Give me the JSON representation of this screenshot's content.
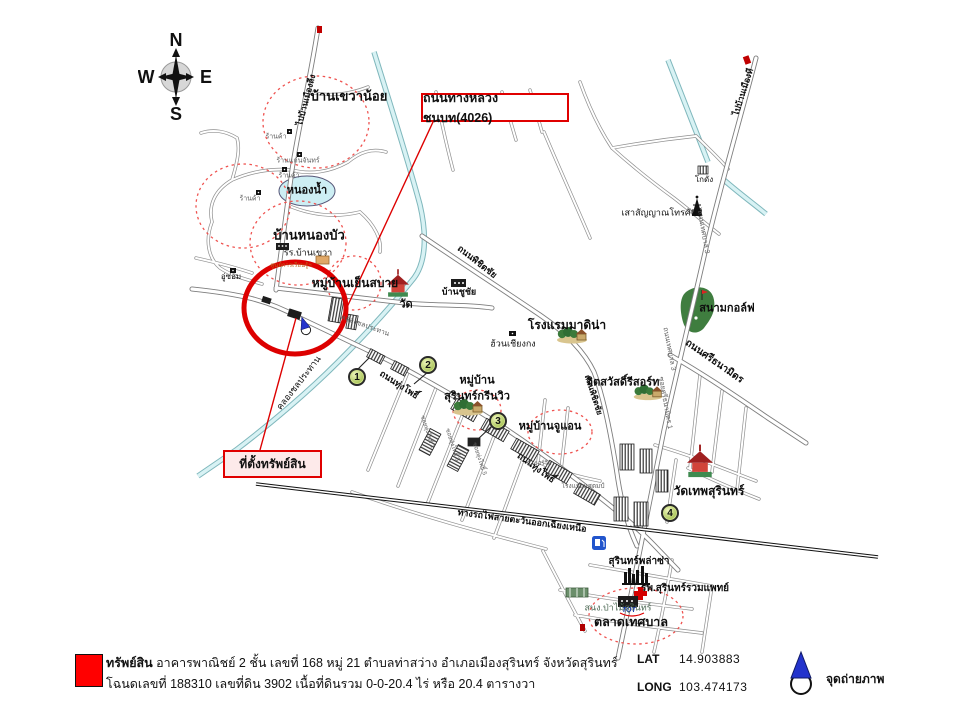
{
  "compass": {
    "n": "N",
    "e": "E",
    "s": "S",
    "w": "W"
  },
  "callouts": {
    "road": "ถนนทางหลวงชนบท(4026)",
    "site": "ที่ตั้งทรัพย์สิน"
  },
  "legend": {
    "swatch_color": "#ff0000",
    "property_bold": "ทรัพย์สิน",
    "property_rest": " อาคารพาณิชย์ 2 ชั้น เลขที่ 168 หมู่ 21  ตำบลท่าสว่าง  อำเภอเมืองสุรินทร์  จังหวัดสุรินทร์",
    "deed_line": "โฉนดเลขที่ 188310 เลขที่ดิน 3902 เนื้อที่ดินรวม 0-0-20.4 ไร่ หรือ 20.4  ตารางวา",
    "lat_label": "LAT",
    "lat_value": "14.903883",
    "long_label": "LONG",
    "long_value": "103.474173",
    "photo_point": "จุดถ่ายภาพ"
  },
  "map": {
    "labels": [
      {
        "t": "ไปบ้านเมืองลีง",
        "x": 306,
        "y": 100,
        "r": -75,
        "s": 8.5,
        "b": 1
      },
      {
        "t": "บ้านเขวาน้อย",
        "x": 349,
        "y": 96,
        "s": 13,
        "b": 1
      },
      {
        "t": "ร้านค้า",
        "x": 276,
        "y": 137,
        "s": 7,
        "c": "gray"
      },
      {
        "t": "ร้านแก่นจันทร์",
        "x": 298,
        "y": 161,
        "s": 7,
        "c": "gray"
      },
      {
        "t": "ร้านค้า",
        "x": 289,
        "y": 176,
        "s": 7,
        "c": "gray"
      },
      {
        "t": "หนองน้ำ",
        "x": 307,
        "y": 191,
        "s": 11,
        "b": 1
      },
      {
        "t": "ร้านค้า",
        "x": 250,
        "y": 199,
        "s": 7,
        "c": "gray"
      },
      {
        "t": "บ้านหนองบัว",
        "x": 309,
        "y": 235,
        "s": 13,
        "b": 1
      },
      {
        "t": "รร.บ้านเขวา",
        "x": 308,
        "y": 253,
        "s": 9
      },
      {
        "t": "ศูนย์การเรียนรู้ฯ",
        "x": 291,
        "y": 266,
        "s": 6,
        "c": "orange"
      },
      {
        "t": "อู่ซ่อม",
        "x": 231,
        "y": 277,
        "s": 8
      },
      {
        "t": "หมู่บ้านเย็นสบาย",
        "x": 355,
        "y": 283,
        "s": 12,
        "b": 1
      },
      {
        "t": "วัด",
        "x": 406,
        "y": 305,
        "s": 11,
        "b": 1
      },
      {
        "t": "บ้านชูชัย",
        "x": 459,
        "y": 292,
        "s": 9,
        "b": 1
      },
      {
        "t": "ถนนพิชิตชัย",
        "x": 477,
        "y": 262,
        "r": 38,
        "s": 9,
        "b": 1
      },
      {
        "t": "โรงแรมมาดิน่า",
        "x": 567,
        "y": 325,
        "s": 12,
        "b": 1
      },
      {
        "t": "ฮ้วนเชียงกง",
        "x": 513,
        "y": 344,
        "s": 9
      },
      {
        "t": "จิตสวัสดิ์รีสอร์ท",
        "x": 623,
        "y": 383,
        "s": 11,
        "b": 1
      },
      {
        "t": "ถนนพิชิตชัย",
        "x": 593,
        "y": 395,
        "r": 72,
        "s": 8,
        "b": 1
      },
      {
        "t": "หมู่บ้าน",
        "x": 477,
        "y": 381,
        "s": 11,
        "b": 1
      },
      {
        "t": "สุรินทร์กรีนวิว",
        "x": 477,
        "y": 397,
        "s": 11,
        "b": 1
      },
      {
        "t": "หมู่บ้านจูแอน",
        "x": 550,
        "y": 427,
        "s": 11,
        "b": 1
      },
      {
        "t": "ถนนทุ่งโพธิ์",
        "x": 399,
        "y": 385,
        "r": 33,
        "s": 9,
        "b": 1
      },
      {
        "t": "ถนนทุ่งโพธิ์",
        "x": 536,
        "y": 468,
        "r": 36,
        "s": 9,
        "b": 1
      },
      {
        "t": "คลองชลประทาน",
        "x": 299,
        "y": 383,
        "r": -52,
        "s": 9
      },
      {
        "t": "คลองชลประทาน",
        "x": 365,
        "y": 326,
        "r": 20,
        "s": 7,
        "c": "gray"
      },
      {
        "t": "ซอยทุ่งโพธิ์ 1",
        "x": 427,
        "y": 432,
        "r": 72,
        "s": 6,
        "c": "gray"
      },
      {
        "t": "ซอยทุ่งโพธิ์ 3",
        "x": 452,
        "y": 445,
        "r": 72,
        "s": 6,
        "c": "gray"
      },
      {
        "t": "ซอยทุ่งโพธิ์ 5",
        "x": 479,
        "y": 459,
        "r": 72,
        "s": 6,
        "c": "gray"
      },
      {
        "t": "ป.เธอร์วิล",
        "x": 539,
        "y": 464,
        "s": 6,
        "c": "gray"
      },
      {
        "t": "โรงแรมแสตมป์",
        "x": 583,
        "y": 487,
        "s": 6.5,
        "c": "gray"
      },
      {
        "t": "ทางรถไฟสายตะวันออกเฉียงเหนือ",
        "x": 522,
        "y": 521,
        "r": 7.5,
        "s": 9,
        "b": 1
      },
      {
        "t": "วัดเทพสุรินทร์",
        "x": 709,
        "y": 491,
        "s": 12,
        "b": 1
      },
      {
        "t": "โกดัง",
        "x": 704,
        "y": 180,
        "s": 8
      },
      {
        "t": "เสาสัญญาณโทรศัพท์",
        "x": 662,
        "y": 213,
        "s": 9
      },
      {
        "t": "ไปบ้านเมืองที",
        "x": 743,
        "y": 92,
        "r": -72,
        "s": 8.5,
        "b": 1
      },
      {
        "t": "ถนนเทศบาล 3",
        "x": 703,
        "y": 232,
        "r": 80,
        "s": 7,
        "c": "gray"
      },
      {
        "t": "สนามกอล์ฟ",
        "x": 727,
        "y": 309,
        "s": 11,
        "b": 1
      },
      {
        "t": "ถนนศรีธนามิตร",
        "x": 714,
        "y": 362,
        "r": 35,
        "s": 10,
        "b": 1
      },
      {
        "t": "ถนนเทศบาล 3",
        "x": 669,
        "y": 349,
        "r": 79,
        "s": 7,
        "c": "gray"
      },
      {
        "t": "ซอยศรีธนามิตร 1",
        "x": 665,
        "y": 403,
        "r": 80,
        "s": 7,
        "c": "gray"
      },
      {
        "t": "สุรินทร์พล่าซ่า",
        "x": 639,
        "y": 562,
        "s": 10,
        "b": 1
      },
      {
        "t": "รพ.สุรินทร์รวมแพทย์",
        "x": 685,
        "y": 589,
        "s": 10,
        "b": 1
      },
      {
        "t": "สนง.ป่าไม้สุรินทร์",
        "x": 618,
        "y": 608,
        "s": 9,
        "c": "green"
      },
      {
        "t": "ตลาดเทศบาล",
        "x": 631,
        "y": 622,
        "s": 12.5,
        "b": 1
      }
    ],
    "markers": [
      {
        "n": "1",
        "x": 357,
        "y": 377
      },
      {
        "n": "2",
        "x": 428,
        "y": 365
      },
      {
        "n": "3",
        "x": 498,
        "y": 421
      },
      {
        "n": "4",
        "x": 670,
        "y": 513
      }
    ],
    "colors": {
      "highlight_circle": "#dd0000",
      "dashed_zone": "#ef5350",
      "canal": "#d8f2f4",
      "pond": "#cdeef3",
      "golf_green": "#3f7d3f",
      "marker_green": "#8fb232"
    }
  }
}
